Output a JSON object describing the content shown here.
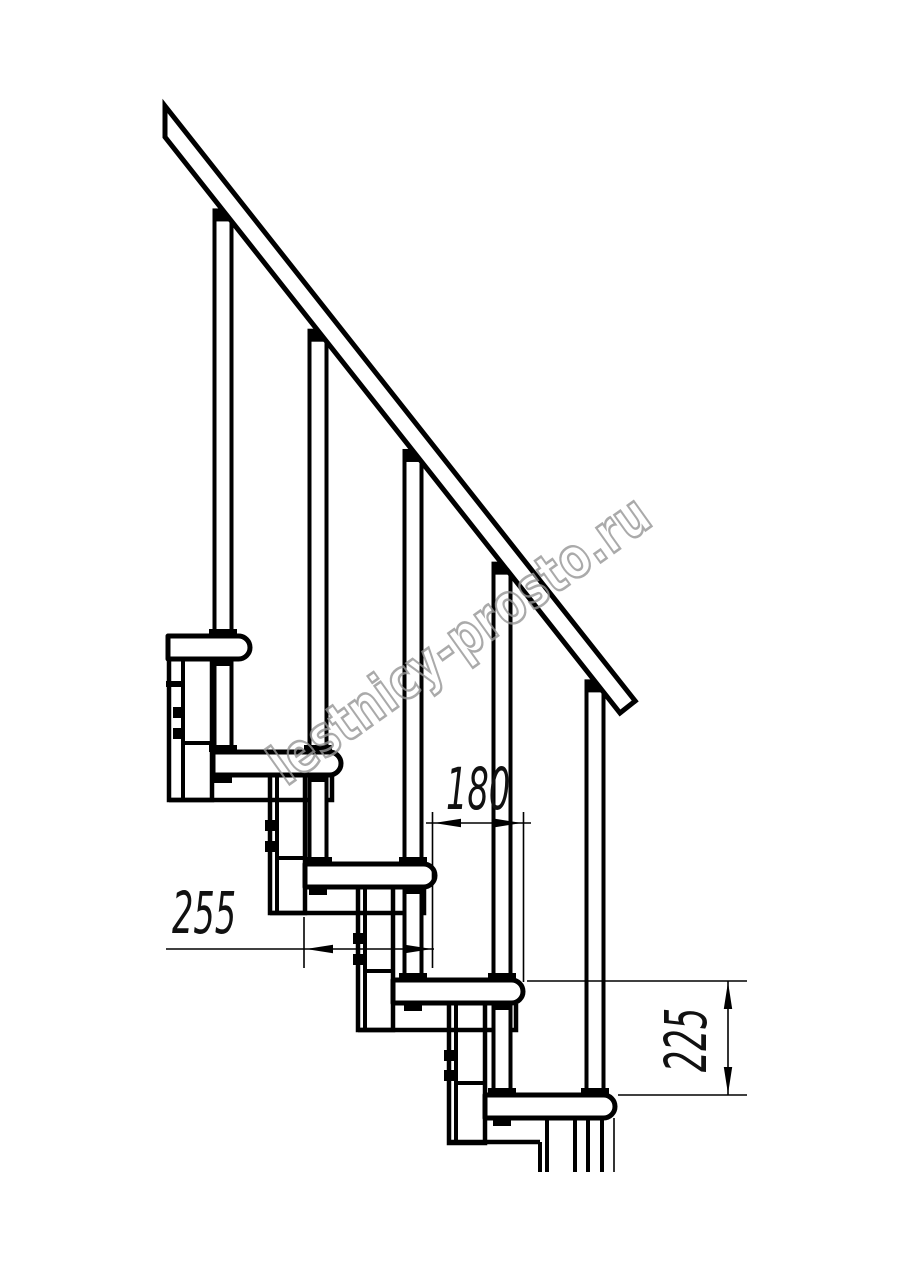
{
  "canvas": {
    "width": 914,
    "height": 1280,
    "background": "#ffffff",
    "ink": "#000000"
  },
  "watermark": {
    "text": "lestnicy-prosto.ru",
    "color": "#969696",
    "rotation_deg": -35.5
  },
  "dims": {
    "d180": {
      "label": "180"
    },
    "d255": {
      "label": "255"
    },
    "d225": {
      "label": "225"
    }
  },
  "drawing": {
    "stroke_thick": 5,
    "stroke_medium": 4,
    "stroke_thin": 1.6,
    "rail": {
      "bx0": 165,
      "by0": 137,
      "slope": 1.266,
      "x_end": 620,
      "poly": [
        [
          165,
          106
        ],
        [
          635.2,
          701
        ],
        [
          620,
          713
        ],
        [
          165,
          137
        ]
      ]
    },
    "tread_h": 23,
    "cap_r": 11.5,
    "treads": [
      {
        "L": 168,
        "R": 250,
        "top": 636
      },
      {
        "L": 213,
        "R": 341,
        "top": 752
      },
      {
        "L": 305,
        "R": 435,
        "top": 864
      },
      {
        "L": 393,
        "R": 523,
        "top": 980
      },
      {
        "L": 485,
        "R": 615,
        "top": 1095
      }
    ],
    "baluster_axes": [
      223,
      318,
      413,
      502,
      595
    ],
    "baluster_half_w": 10.5,
    "stanchions": [
      {
        "a": 223,
        "y0": 659,
        "y1": 752
      },
      {
        "a": 318,
        "y0": 775,
        "y1": 864
      },
      {
        "a": 413,
        "y0": 887,
        "y1": 980
      },
      {
        "a": 502,
        "y0": 1003,
        "y1": 1095
      }
    ],
    "boxes": [
      {
        "x0": 169,
        "x1": 212,
        "y0": 659,
        "y1": 800,
        "inner": 183,
        "divY": 743,
        "boltCx": 178,
        "boltYs": [
          707,
          728
        ],
        "tick": true
      },
      {
        "x0": 270,
        "x1": 305,
        "y0": 775,
        "y1": 913,
        "inner": 277,
        "divY": 858,
        "boltCx": 270,
        "boltYs": [
          820,
          841
        ],
        "tick": false
      },
      {
        "x0": 358,
        "x1": 393,
        "y0": 887,
        "y1": 1030,
        "inner": 365,
        "divY": 971,
        "boltCx": 358,
        "boltYs": [
          933,
          954
        ],
        "tick": false
      },
      {
        "x0": 449,
        "x1": 485,
        "y0": 1003,
        "y1": 1143,
        "inner": 456,
        "divY": 1083,
        "boltCx": 449,
        "boltYs": [
          1050,
          1070
        ],
        "tick": false
      }
    ],
    "outlines": [
      [
        [
          169,
          800
        ],
        [
          332,
          800
        ],
        [
          332,
          776
        ]
      ],
      [
        [
          270,
          913
        ],
        [
          424,
          913
        ],
        [
          424,
          888
        ]
      ],
      [
        [
          358,
          1030
        ],
        [
          516,
          1030
        ],
        [
          516,
          1004
        ]
      ],
      [
        [
          449,
          1142
        ],
        [
          540,
          1142
        ]
      ]
    ],
    "legs": [
      {
        "x": 540,
        "y0": 1142,
        "y1": 1172,
        "thin": false
      },
      {
        "x": 547,
        "y0": 1118,
        "y1": 1172,
        "thin": false
      },
      {
        "x": 575,
        "y0": 1118,
        "y1": 1172,
        "thin": false
      },
      {
        "x": 588,
        "y0": 1118,
        "y1": 1172,
        "thin": false
      },
      {
        "x": 602,
        "y0": 1118,
        "y1": 1172,
        "thin": false
      },
      {
        "x": 614,
        "y0": 1118,
        "y1": 1172,
        "thin": true
      }
    ],
    "dim_geometry": {
      "d255": {
        "line": {
          "y": 949,
          "x0": 166,
          "x1": 434
        },
        "vexts": [
          {
            "x": 304,
            "y0": 917,
            "y1": 968
          }
        ],
        "arrows": [
          {
            "tip": [
              306,
              949
            ],
            "dir": "left"
          },
          {
            "tip": [
              432,
              949
            ],
            "dir": "right"
          }
        ],
        "text_pos": {
          "x": 172,
          "y": 884
        }
      },
      "d180": {
        "line": {
          "y": 823,
          "x0": 426,
          "x1": 531
        },
        "vexts": [
          {
            "x": 432.5,
            "y0": 812,
            "y1": 968
          },
          {
            "x": 523.5,
            "y0": 812,
            "y1": 982
          }
        ],
        "arrows": [
          {
            "tip": [
              434,
              823
            ],
            "dir": "left"
          },
          {
            "tip": [
              522,
              823
            ],
            "dir": "right"
          }
        ],
        "text_pos": {
          "x": 446,
          "y": 760
        }
      },
      "d225": {
        "vline": {
          "x": 728,
          "y0": 981,
          "y1": 1095
        },
        "hexts": [
          {
            "y": 981,
            "x0": 527,
            "x1": 747
          },
          {
            "y": 1095,
            "x0": 618,
            "x1": 747
          }
        ],
        "arrows": [
          {
            "tip": [
              728,
              982
            ],
            "dir": "up"
          },
          {
            "tip": [
              728,
              1094
            ],
            "dir": "down"
          }
        ],
        "text_center": {
          "x": 686,
          "y": 1040
        }
      }
    }
  }
}
